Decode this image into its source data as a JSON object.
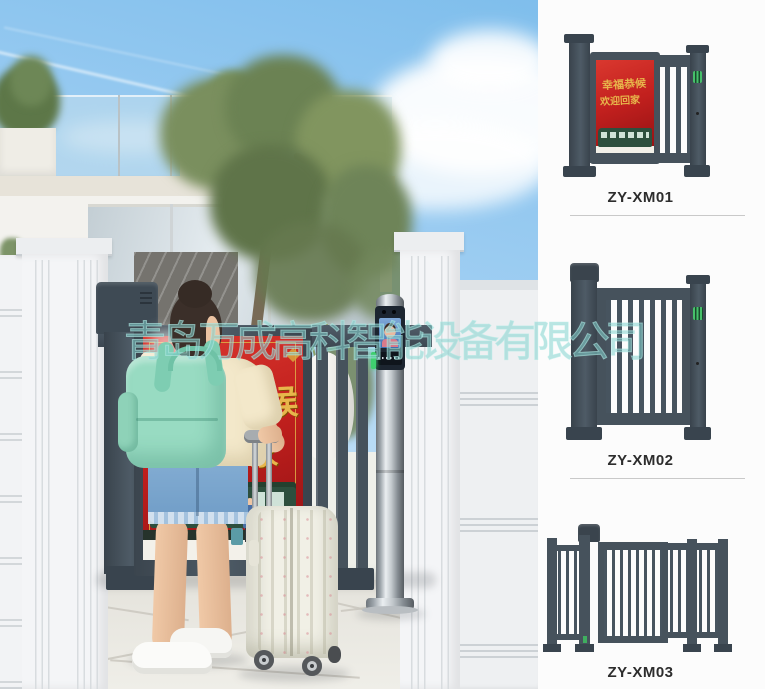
{
  "watermark": {
    "text": "青岛万成高科智能设备有限公司",
    "color": "#84d2ce"
  },
  "scene": {
    "poster": {
      "line1": "幸福恭候",
      "line2": "欢迎回家"
    },
    "backpack_tag": "チコミル"
  },
  "products": [
    {
      "label": "ZY-XM01",
      "poster": {
        "line1": "幸福恭候",
        "line2": "欢迎回家"
      }
    },
    {
      "label": "ZY-XM02"
    },
    {
      "label": "ZY-XM03"
    }
  ],
  "colors": {
    "gate_slate": "#47545f",
    "poster_red": "#c2201e",
    "poster_gold": "#e7b64b",
    "backpack_mint": "#97dac1",
    "divider": "#c9c9c9"
  }
}
